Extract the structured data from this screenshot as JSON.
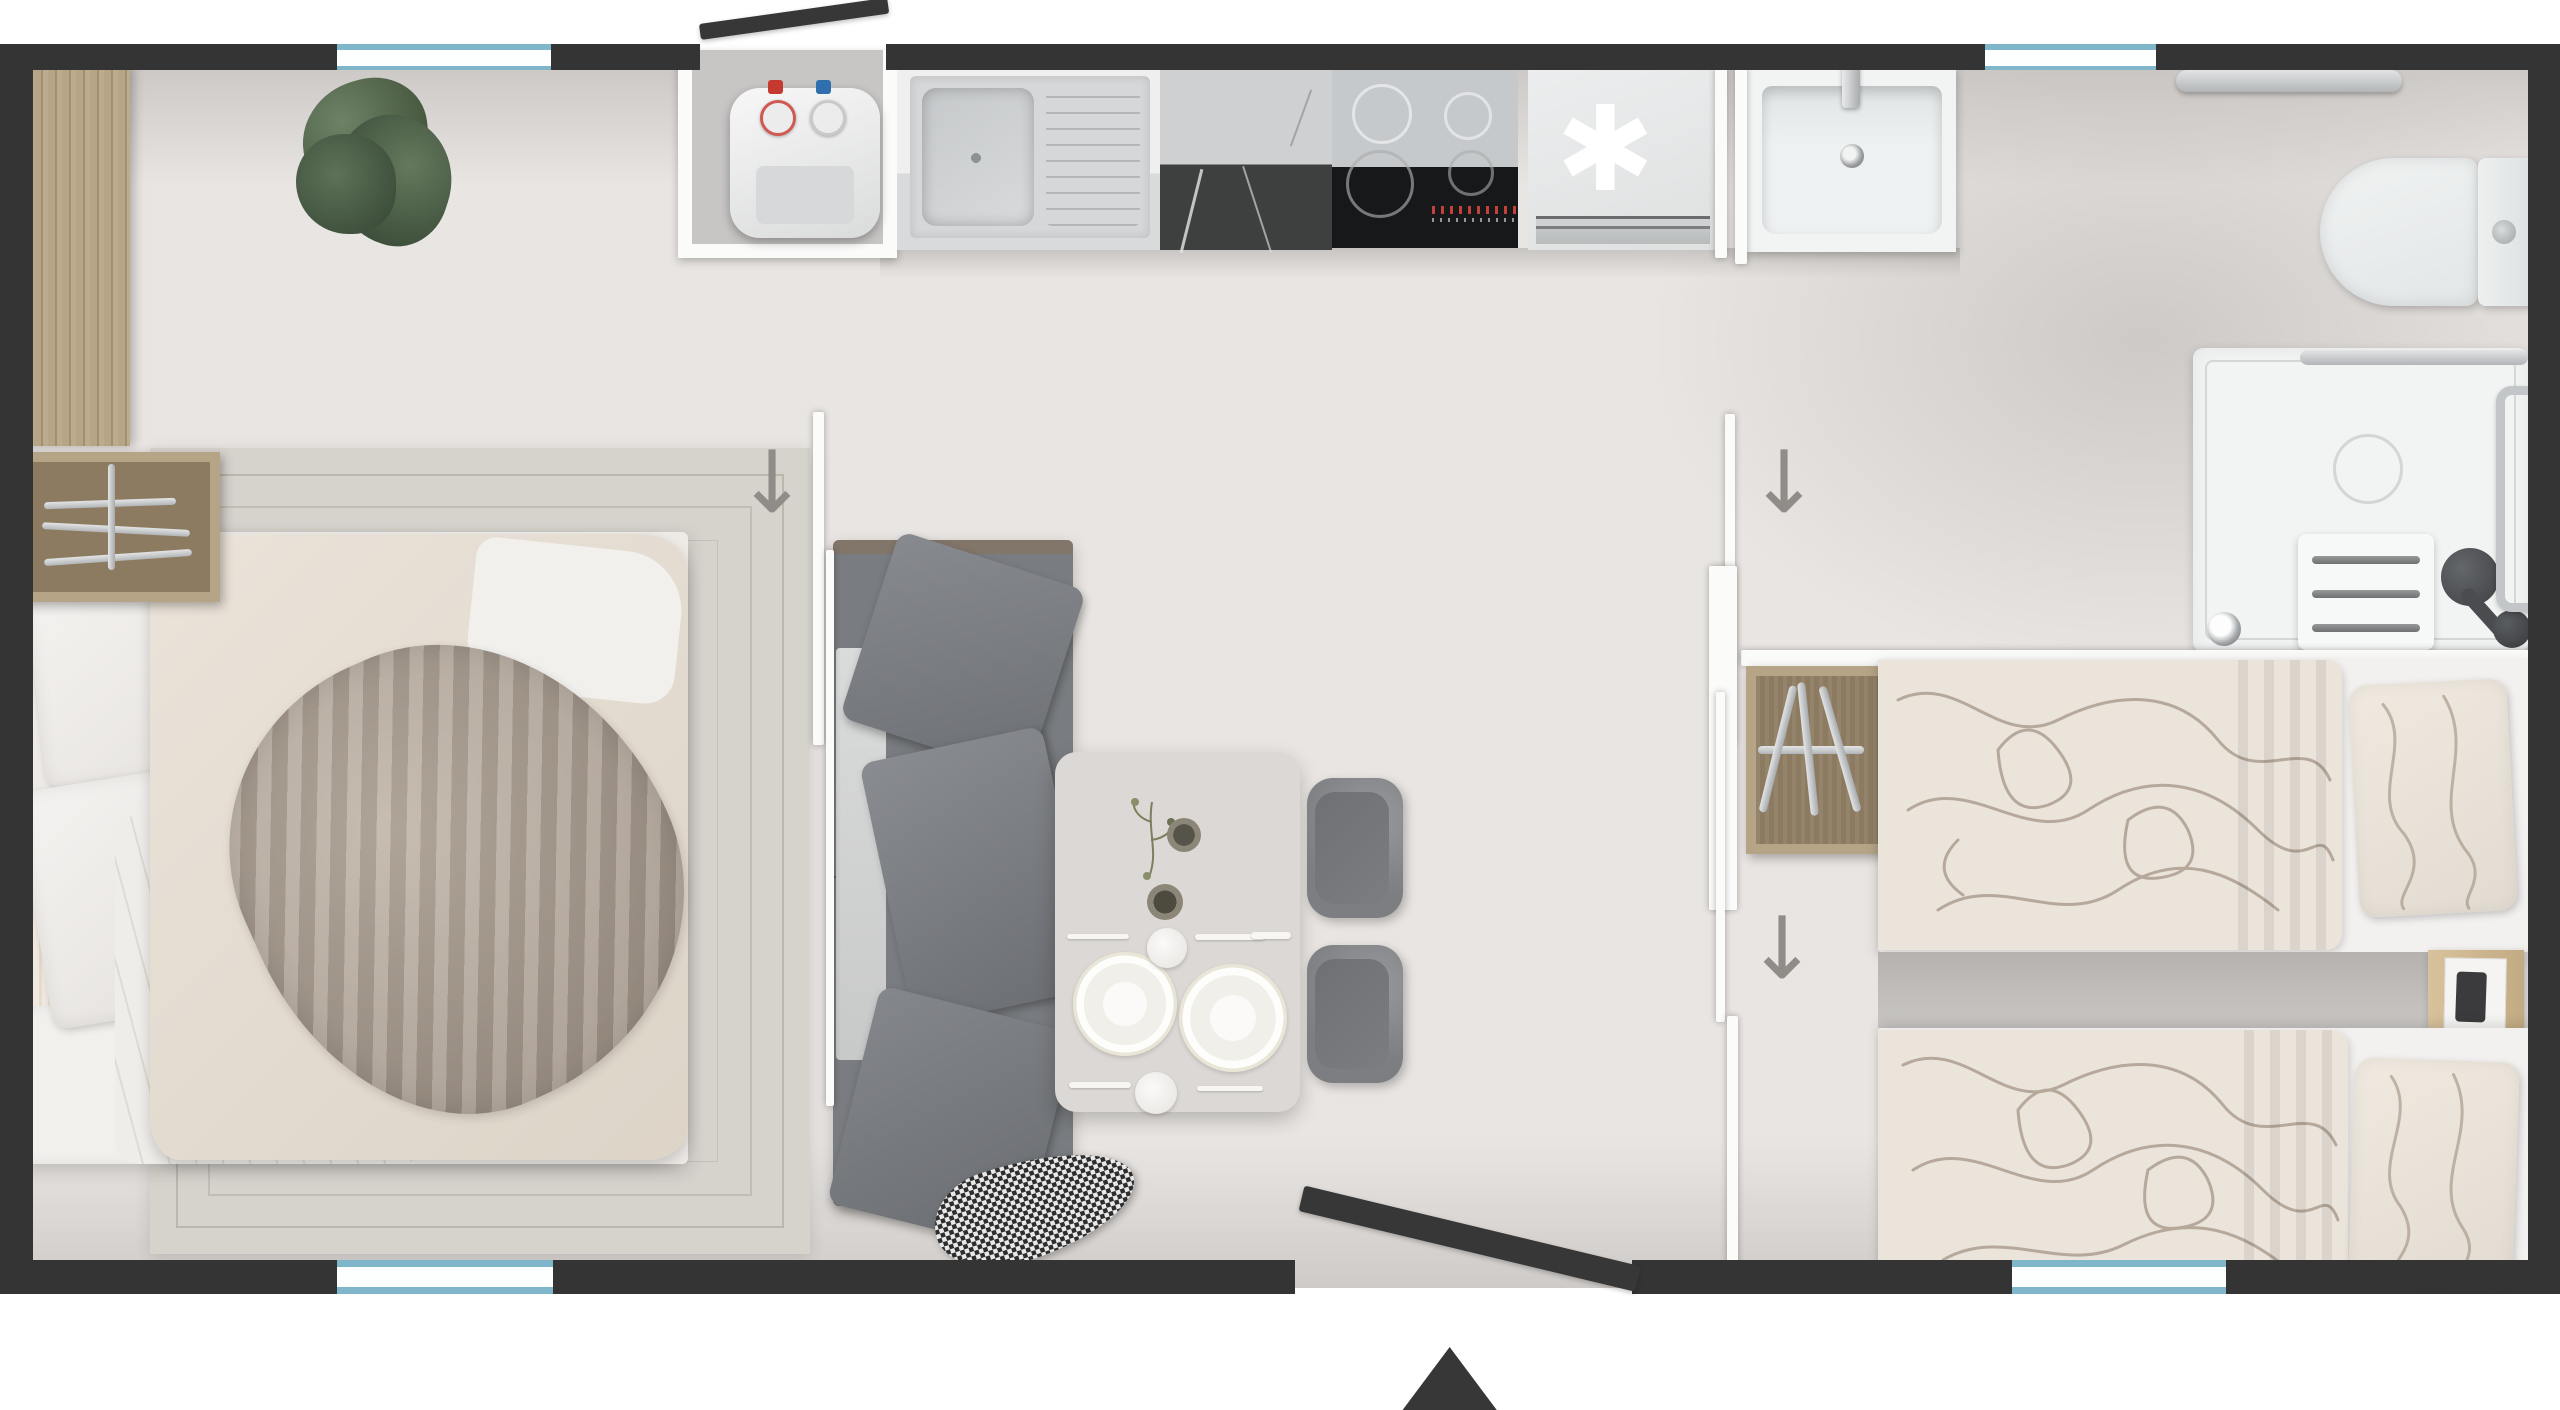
{
  "meta": {
    "title": "Mobile home floor plan — top view",
    "view": "2D overhead render",
    "visible_text": "none"
  },
  "symbols": {
    "freezer": "✱",
    "door_arrow": "↓",
    "entrance_arrow": "▲"
  },
  "colors": {
    "wall": "#343434",
    "door": "#373737",
    "window": "#7fb6ca",
    "window_white": "#fdfefe",
    "floor": "#e9e5e2",
    "niche": "#c8c6c5",
    "partition": "#fbfbfa",
    "wood": "#b3a184",
    "wood_dark": "#8f7d63",
    "bench": "#ece3d5",
    "rug": "#d6d2cc",
    "rug_line": "#aaa294",
    "linen": "#f2f0ed",
    "duvet": "#e7e0d6",
    "taupe": "#b2a698",
    "sofa": "#797c80",
    "cushion": "#7e8186",
    "chaise": "#d7d8d8",
    "table": "#dcd8d5",
    "chair": "#85878a",
    "chair_seat": "#6f7173",
    "steel": "#d5d7d8",
    "marble": "#3e403f",
    "cooktop": "#17181a",
    "glass": "#c6c9cb",
    "appliance": "#e7e9e9",
    "fixture": "#f2f3f3",
    "chrome": "#c3c6c8",
    "floral_base": "#ebe4db",
    "floral_line": "#a09081",
    "wardrobe": "#b5a486",
    "wardrobe_in": "#8d7b61",
    "nightstand": "#d0ba92",
    "arrow": "#908c87",
    "plant": "#5d7258",
    "plant_dark": "#3d4e3a",
    "red": "#c5392f",
    "blue": "#2f6fad"
  },
  "rooms": [
    {
      "id": "master-bedroom",
      "furniture": [
        "double-bed",
        "rug",
        "tall-wardrobe",
        "rail-shelf",
        "plant"
      ]
    },
    {
      "id": "living-kitchen",
      "furniture": [
        "corner-sofa",
        "throw-blanket",
        "dining-table",
        "chair",
        "chair",
        "kitchen-sink",
        "marble-counter",
        "induction-cooktop",
        "fridge-freezer",
        "water-heater-closet"
      ]
    },
    {
      "id": "hallway",
      "furniture": [
        "bathroom-sink",
        "open-wardrobe"
      ]
    },
    {
      "id": "bathroom",
      "furniture": [
        "toilet",
        "shower",
        "shower-seat",
        "towel-rail",
        "grab-bar",
        "hand-shower"
      ]
    },
    {
      "id": "twin-bedroom",
      "furniture": [
        "twin-bed",
        "twin-bed",
        "nightstand"
      ]
    }
  ],
  "openings": {
    "windows": [
      "top-left",
      "top-right",
      "bottom-left",
      "bottom-right"
    ],
    "doors": [
      "entrance-bottom-center",
      "vent-flap-top",
      "sliding-door-left",
      "sliding-door-right-upper",
      "sliding-door-right-lower"
    ]
  }
}
